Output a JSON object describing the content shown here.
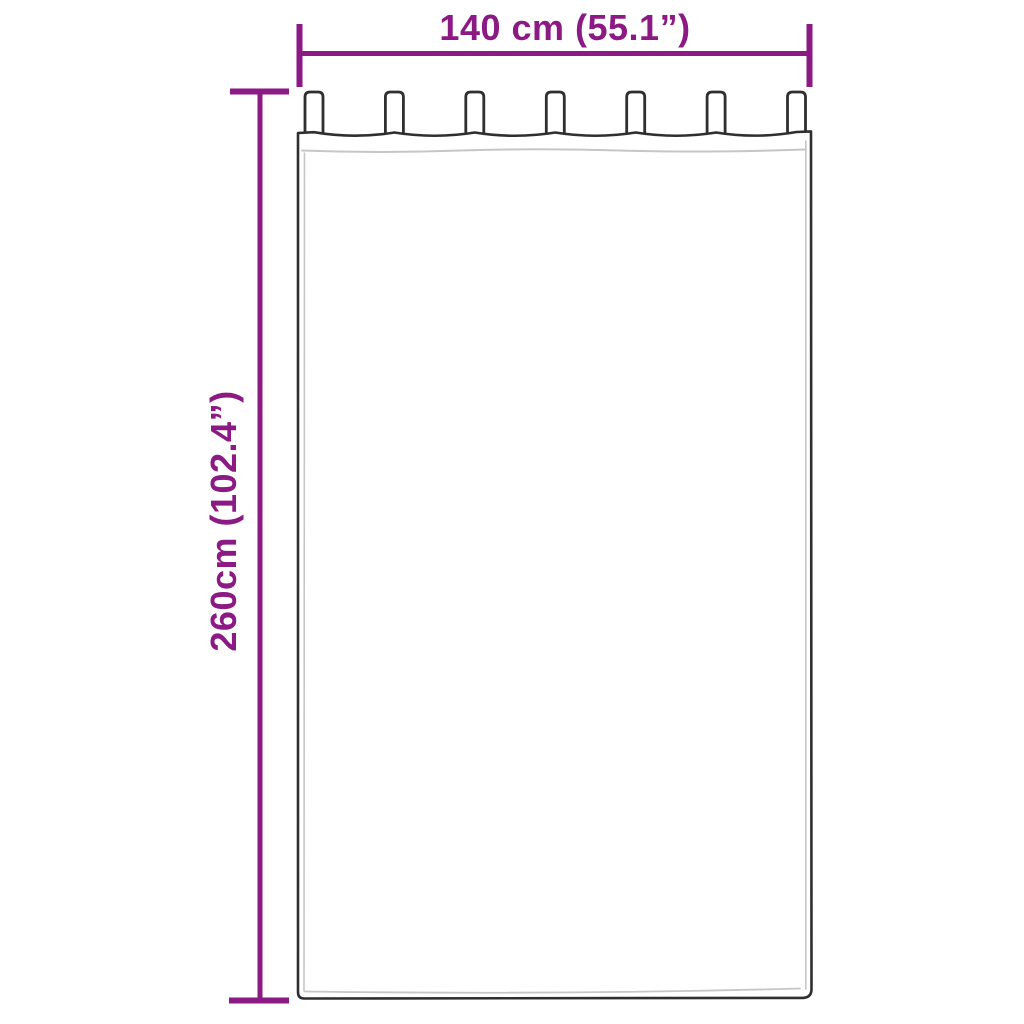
{
  "diagram": {
    "width_label": "140 cm (55.1”)",
    "height_label": "260cm (102.4”)",
    "dimensions": {
      "width_cm": 140,
      "width_inches": 55.1,
      "height_cm": 260,
      "height_inches": 102.4
    },
    "tab_count": 7,
    "colors": {
      "dimension_accent": "#8C1A84",
      "outline": "#2F2F2F",
      "fold_line": "#C6C6C6",
      "background": "#FFFFFF"
    }
  }
}
